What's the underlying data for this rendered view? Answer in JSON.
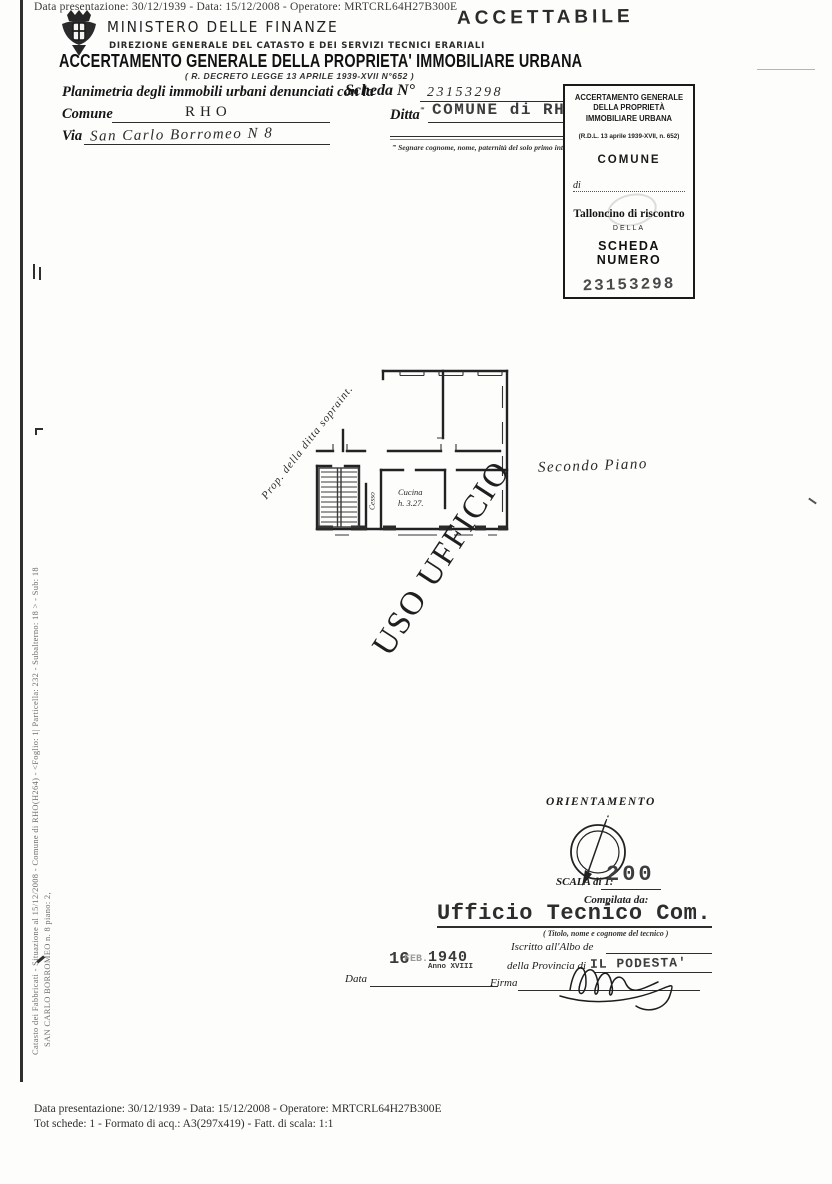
{
  "meta": {
    "top_line": "Data presentazione: 30/12/1939 - Data: 15/12/2008 - Operatore: MRTCRL64H27B300E",
    "footer_line1": "Data presentazione: 30/12/1939 - Data: 15/12/2008 - Operatore: MRTCRL64H27B300E",
    "footer_line2": "Tot schede: 1 - Formato di acq.: A3(297x419) - Fatt. di scala: 1:1"
  },
  "side": {
    "line1": "Catasto dei Fabbricati - Situazione al 15/12/2008 - Comune di RHO(H264) - <Foglio: 1| Particella: 232 - Subalterno: 18 > - Sub: 18",
    "line2": "SAN CARLO BORROMEO n. 8 piano: 2,"
  },
  "header": {
    "ministry": "MINISTERO DELLE FINANZE",
    "direction": "DIREZIONE GENERALE DEL CATASTO E DEI SERVIZI TECNICI ERARIALI",
    "title": "ACCERTAMENTO GENERALE DELLA PROPRIETA' IMMOBILIARE URBANA",
    "law": "( R. DECRETO LEGGE 13 APRILE 1939-XVII N°652 )",
    "accettabile_stamp": "ACCETTABILE"
  },
  "form": {
    "planimetria_label": "Planimetria degli immobili urbani denunciati con la",
    "scheda_label": "Scheda N°",
    "scheda_number": "23153298",
    "comune_label": "Comune",
    "comune_value": "RHO",
    "ditta_label": "Ditta",
    "ref_marker": "‴",
    "ditta_value": "COMUNE di RHO",
    "via_label": "Via",
    "via_value": "San Carlo Borromeo N 8",
    "footnote": "‴ Segnare cognome, nome, paternità del solo primo intestatario"
  },
  "talloncino": {
    "title": "ACCERTAMENTO GENERALE DELLA PROPRIETÀ IMMOBILIARE URBANA",
    "law": "(R.D.L. 13 aprile 1939-XVII, n. 652)",
    "comune_label": "COMUNE",
    "di_label": "di",
    "talloncino_label": "Talloncino di riscontro",
    "della_label": "DELLA",
    "scheda_label": "SCHEDA NUMERO",
    "scheda_number": "23153298"
  },
  "plan": {
    "prop_note": "Prop. della ditta sopraint.",
    "floor_label": "Secondo Piano",
    "kitchen_label": "Cucina",
    "kitchen_height": "h. 3.27.",
    "wc_label": "Cesso",
    "watermark": "USO UFFICIO"
  },
  "orientation": {
    "title": "ORIENTAMENTO",
    "scala_label": "SCALA di 1:",
    "scala_value": "200"
  },
  "signoff": {
    "compilata_label": "Compilata da:",
    "tecnico_value": "Ufficio Tecnico Com.",
    "tecnico_note": "( Titolo, nome e cognome del tecnico )",
    "albo_label": "Iscritto all'Albo de",
    "provincia_label": "della Provincia di",
    "podesta_stamp": "IL PODESTA'",
    "data_label": "Data",
    "date_stamp_day": "16",
    "date_stamp_month": "FEB.",
    "date_stamp_year": "1940",
    "date_stamp_era": "Anno XVIII",
    "firma_label": "Firma"
  }
}
